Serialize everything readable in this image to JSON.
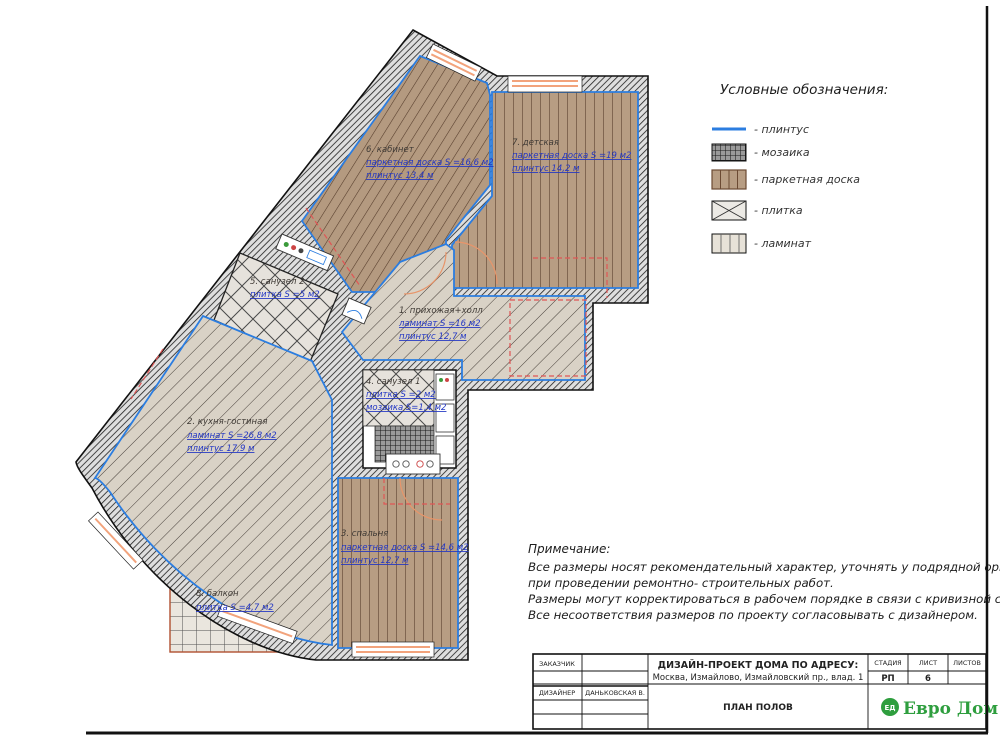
{
  "legend": {
    "title": "Условные обозначения:",
    "items": [
      {
        "label": "- плинтус"
      },
      {
        "label": "- мозаика"
      },
      {
        "label": "- паркетная доска"
      },
      {
        "label": "- плитка"
      },
      {
        "label": "- ламинат"
      }
    ]
  },
  "rooms": {
    "r1": {
      "name": "1. прихожая+холл",
      "lines": [
        "ламинат S =16 м2",
        "плинтус 12,7 м"
      ]
    },
    "r2": {
      "name": "2. кухня-гостиная",
      "lines": [
        "ламинат S =26,8  м2",
        "плинтус 17,9 м"
      ]
    },
    "r3": {
      "name": "3. спальня",
      "lines": [
        "паркетная доска S =14,6  м2",
        "плинтус 12,7 м"
      ]
    },
    "r4": {
      "name": "4. санузел 1",
      "lines": [
        "плитка S =2 м2",
        "мозаика S=1,4 м2"
      ]
    },
    "r5": {
      "name": "5. санузел 2",
      "lines": [
        "плитка S =5  м2"
      ]
    },
    "r6": {
      "name": "6. кабинет",
      "lines": [
        "паркетная доска S =16,6  м2",
        "плинтус 13,4 м"
      ]
    },
    "r7": {
      "name": "7. детская",
      "lines": [
        "паркетная доска S =19 м2",
        "плинтус 14,2 м"
      ]
    },
    "r8": {
      "name": "8. балкон",
      "lines": [
        "плитка S =4,7  м2"
      ]
    }
  },
  "notes": {
    "title": "Примечание:",
    "lines": [
      "Все размеры носят рекомендательный характер, уточнять у подрядной организации",
      "при проведении ремонтно- строительных работ.",
      "Размеры могут корректироваться в рабочем порядке в связи с кривизной стен.",
      "Все несоответствия размеров по проекту согласовывать с дизайнером."
    ]
  },
  "titleblock": {
    "customer_label": "ЗАКАЗЧИК",
    "designer_label": "ДИЗАЙНЕР",
    "designer_value": "ДАНЬКОВСКАЯ В.",
    "project_title": "ДИЗАЙН-ПРОЕКТ ДОМА ПО АДРЕСУ:",
    "project_address": "Москва, Измайлово, Измайловский пр., влад. 1",
    "sheet_title": "ПЛАН ПОЛОВ",
    "stage_label": "СТАДИЯ",
    "sheet_label": "ЛИСТ",
    "sheets_label": "ЛИСТОВ",
    "stage_value": "РП",
    "sheet_value": "6",
    "sheets_value": "",
    "logo_badge": "ЕД",
    "logo_text": "Евро Дом"
  },
  "colors": {
    "baseboard_blue": "#2b7de0",
    "wood_tan": "#b79d83",
    "window_orange": "#f2a37c",
    "transition_red": "#e05555",
    "logo_green": "#2e9e3e"
  }
}
